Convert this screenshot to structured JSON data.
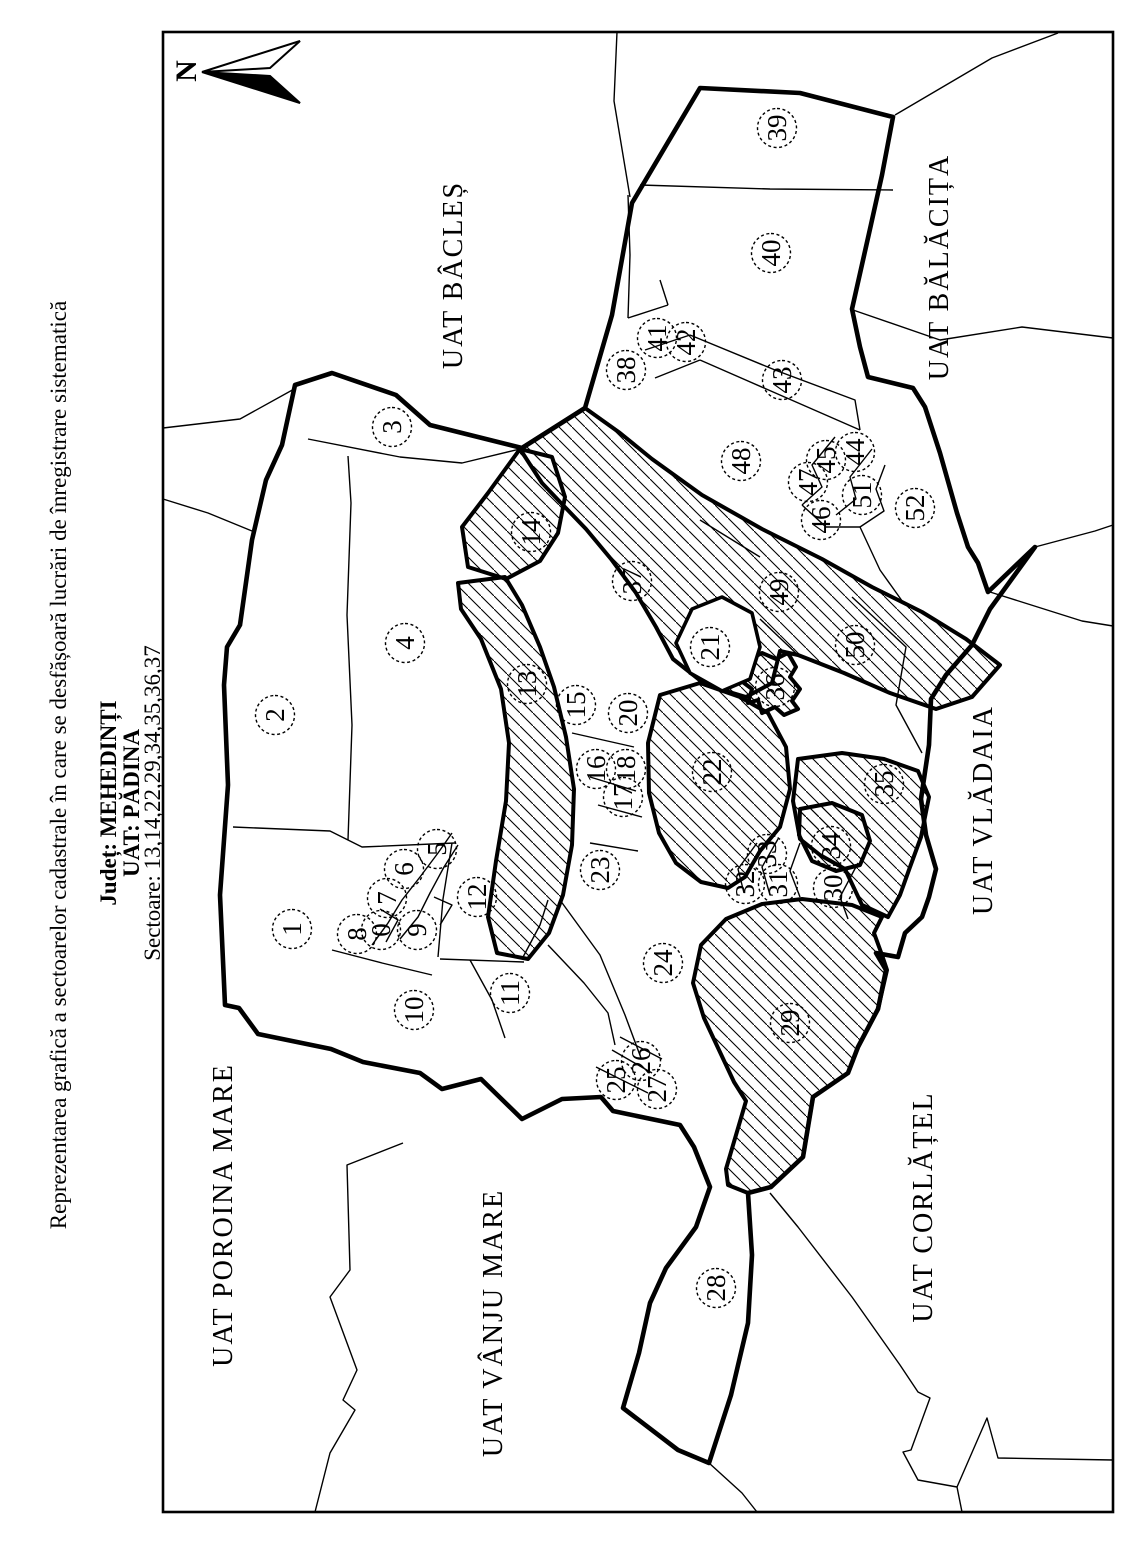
{
  "title": {
    "line1": "Reprezentarea grafică a sectoarelor cadastrale în care se desfășoară lucrări de înregistrare sistematică",
    "line2": "Județ: MEHEDINȚI",
    "line3": "UAT: PĂDINA",
    "line4": "Sectoare: 13,14,22,29,34,35,36,37"
  },
  "north_label": "N",
  "colors": {
    "ink": "#000000",
    "paper": "#ffffff"
  },
  "hatched_sectors": [
    "13",
    "14",
    "22",
    "29",
    "34",
    "35",
    "36",
    "37"
  ],
  "sectors": [
    {
      "n": "0",
      "x": 615,
      "y": 381
    },
    {
      "n": "1",
      "x": 616,
      "y": 292
    },
    {
      "n": "2",
      "x": 830,
      "y": 275
    },
    {
      "n": "3",
      "x": 1118,
      "y": 392
    },
    {
      "n": "4",
      "x": 902,
      "y": 405
    },
    {
      "n": "5",
      "x": 696,
      "y": 437
    },
    {
      "n": "6",
      "x": 676,
      "y": 404
    },
    {
      "n": "7",
      "x": 647,
      "y": 387
    },
    {
      "n": "8",
      "x": 611,
      "y": 357
    },
    {
      "n": "9",
      "x": 615,
      "y": 417
    },
    {
      "n": "10",
      "x": 535,
      "y": 414
    },
    {
      "n": "11",
      "x": 552,
      "y": 510
    },
    {
      "n": "12",
      "x": 648,
      "y": 477
    },
    {
      "n": "13",
      "x": 861,
      "y": 527
    },
    {
      "n": "14",
      "x": 1013,
      "y": 531
    },
    {
      "n": "15",
      "x": 840,
      "y": 576
    },
    {
      "n": "16",
      "x": 776,
      "y": 596
    },
    {
      "n": "17",
      "x": 748,
      "y": 623
    },
    {
      "n": "18",
      "x": 776,
      "y": 626
    },
    {
      "n": "20",
      "x": 832,
      "y": 628
    },
    {
      "n": "21",
      "x": 898,
      "y": 710
    },
    {
      "n": "22",
      "x": 773,
      "y": 712
    },
    {
      "n": "23",
      "x": 675,
      "y": 600
    },
    {
      "n": "24",
      "x": 582,
      "y": 663
    },
    {
      "n": "25",
      "x": 465,
      "y": 616
    },
    {
      "n": "26",
      "x": 484,
      "y": 641
    },
    {
      "n": "27",
      "x": 456,
      "y": 657
    },
    {
      "n": "28",
      "x": 257,
      "y": 716
    },
    {
      "n": "29",
      "x": 522,
      "y": 790
    },
    {
      "n": "30",
      "x": 657,
      "y": 833
    },
    {
      "n": "31",
      "x": 661,
      "y": 778
    },
    {
      "n": "32",
      "x": 661,
      "y": 745
    },
    {
      "n": "33",
      "x": 691,
      "y": 767
    },
    {
      "n": "34",
      "x": 699,
      "y": 831
    },
    {
      "n": "35",
      "x": 761,
      "y": 884
    },
    {
      "n": "36",
      "x": 858,
      "y": 775
    },
    {
      "n": "37",
      "x": 964,
      "y": 632
    },
    {
      "n": "38",
      "x": 1175,
      "y": 626
    },
    {
      "n": "39",
      "x": 1417,
      "y": 777
    },
    {
      "n": "40",
      "x": 1292,
      "y": 771
    },
    {
      "n": "41",
      "x": 1207,
      "y": 657
    },
    {
      "n": "42",
      "x": 1203,
      "y": 686
    },
    {
      "n": "43",
      "x": 1165,
      "y": 782
    },
    {
      "n": "44",
      "x": 1093,
      "y": 855
    },
    {
      "n": "45",
      "x": 1085,
      "y": 826
    },
    {
      "n": "46",
      "x": 1025,
      "y": 821
    },
    {
      "n": "47",
      "x": 1063,
      "y": 808
    },
    {
      "n": "48",
      "x": 1084,
      "y": 741
    },
    {
      "n": "49",
      "x": 953,
      "y": 779
    },
    {
      "n": "50",
      "x": 900,
      "y": 855
    },
    {
      "n": "51",
      "x": 1050,
      "y": 862
    },
    {
      "n": "52",
      "x": 1037,
      "y": 915
    }
  ],
  "neighbors": [
    {
      "name": "UAT BÂCLEȘ",
      "x": 1270,
      "y": 462
    },
    {
      "name": "UAT BĂLĂCIȚA",
      "x": 1278,
      "y": 948
    },
    {
      "name": "UAT POROINA MARE",
      "x": 330,
      "y": 232
    },
    {
      "name": "UAT VÂNJU MARE",
      "x": 222,
      "y": 502
    },
    {
      "name": "UAT CORLĂȚEL",
      "x": 338,
      "y": 932
    },
    {
      "name": "UAT VLĂDAIA",
      "x": 735,
      "y": 992
    }
  ]
}
